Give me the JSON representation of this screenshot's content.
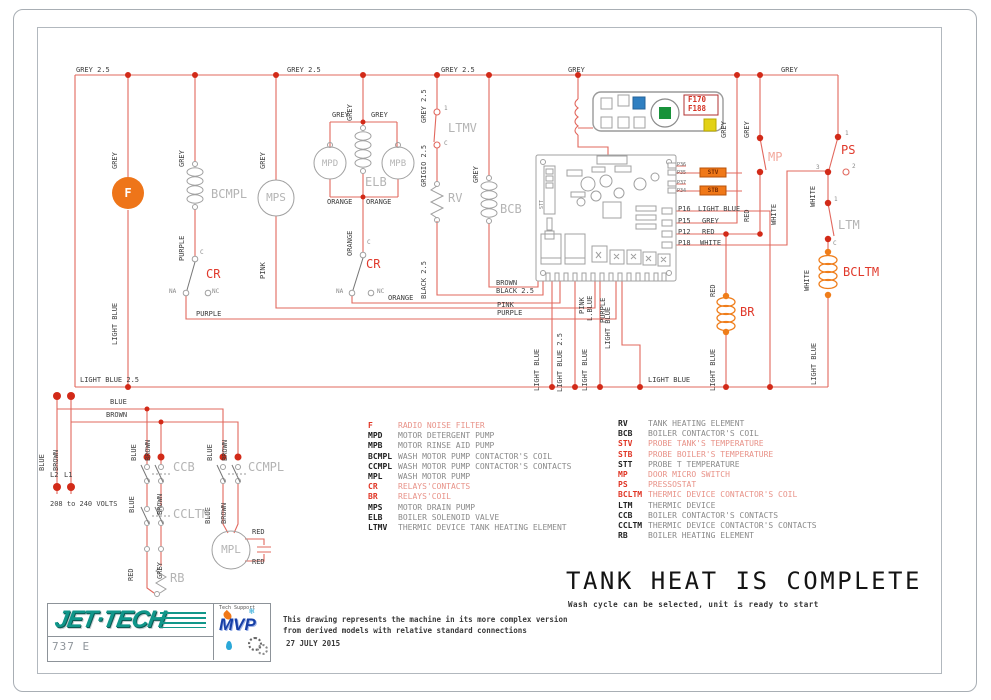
{
  "w": {
    "grey25": "GREY 2.5",
    "grey": "GREY",
    "grigio25": "GRIGIO 2.5",
    "black25": "BLACK 2.5",
    "lightblue": "LIGHT BLUE",
    "lightblue25": "LIGHT BLUE 2.5",
    "lblue": "L.BLUE",
    "purple": "PURPLE",
    "pink": "PINK",
    "orange": "ORANGE",
    "blue": "BLUE",
    "brown": "BROWN",
    "red": "RED",
    "white": "WHITE"
  },
  "c": {
    "f": "F",
    "bcmpl": "BCMPL",
    "mps": "MPS",
    "mpd": "MPD",
    "mpb": "MPB",
    "elb": "ELB",
    "cr": "CR",
    "ltmv": "LTMV",
    "rv": "RV",
    "bcb": "BCB",
    "mp": "MP",
    "ps": "PS",
    "ltm": "LTM",
    "bcltm": "BCLTM",
    "br": "BR",
    "ccb": "CCB",
    "ccmpl": "CCMPL",
    "ccltm": "CCLTM",
    "mpl": "MPL",
    "rb": "RB",
    "stt": "STT",
    "stv": "STV",
    "stb": "STB",
    "na": "NA",
    "nc": "NC",
    "cterm": "C",
    "t1": "1",
    "t2": "2",
    "t3": "3",
    "l1": "L1",
    "l2": "L2"
  },
  "board": {
    "p16": "P16",
    "p15": "P15",
    "p12": "P12",
    "p18": "P18",
    "p36": "P36",
    "p35": "P35",
    "p37": "P37",
    "p34": "P34"
  },
  "display": {
    "f170": "F170",
    "f188": "F188"
  },
  "power": {
    "volts": "208 to 240 VOLTS"
  },
  "status": {
    "title": "TANK HEAT IS COMPLETE",
    "subtitle": "Wash cycle can be selected, unit is ready to start"
  },
  "legend_left": [
    {
      "k": "F",
      "d": "RADIO NOISE FILTER"
    },
    {
      "k": "MPD",
      "d": "MOTOR DETERGENT PUMP"
    },
    {
      "k": "MPB",
      "d": "MOTOR RINSE AID PUMP"
    },
    {
      "k": "BCMPL",
      "d": "WASH MOTOR PUMP CONTACTOR'S COIL"
    },
    {
      "k": "CCMPL",
      "d": "WASH MOTOR PUMP CONTACTOR'S CONTACTS"
    },
    {
      "k": "MPL",
      "d": "WASH MOTOR PUMP"
    },
    {
      "k": "CR",
      "d": "RELAYS'CONTACTS"
    },
    {
      "k": "BR",
      "d": "RELAYS'COIL"
    },
    {
      "k": "MPS",
      "d": "MOTOR DRAIN PUMP"
    },
    {
      "k": "ELB",
      "d": "BOILER SOLENOID VALVE"
    },
    {
      "k": "LTMV",
      "d": "THERMIC DEVICE TANK HEATING ELEMENT"
    }
  ],
  "legend_right": [
    {
      "k": "RV",
      "d": "TANK HEATING ELEMENT"
    },
    {
      "k": "BCB",
      "d": "BOILER CONTACTOR'S COIL"
    },
    {
      "k": "STV",
      "d": "PROBE TANK'S TEMPERATURE"
    },
    {
      "k": "STB",
      "d": "PROBE BOILER'S TEMPERATURE"
    },
    {
      "k": "STT",
      "d": "PROBE T TEMPERATURE"
    },
    {
      "k": "MP",
      "d": "DOOR MICRO SWITCH"
    },
    {
      "k": "PS",
      "d": "PRESSOSTAT"
    },
    {
      "k": "BCLTM",
      "d": "THERMIC DEVICE CONTACTOR'S COIL"
    },
    {
      "k": "LTM",
      "d": "THERMIC DEVICE"
    },
    {
      "k": "CCB",
      "d": "BOILER CONTACTOR'S CONTACTS"
    },
    {
      "k": "CCLTM",
      "d": "THERMIC DEVICE CONTACTOR'S CONTACTS"
    },
    {
      "k": "RB",
      "d": "BOILER HEATING ELEMENT"
    }
  ],
  "footer": {
    "brand": "JET·TECH",
    "model": "737 E",
    "mvp": "MVP",
    "tech_support": "Tech Support",
    "note1": "This drawing represents the machine in its more complex version",
    "note2": "from derived models with relative standard connections",
    "date": "27 JULY 2015"
  }
}
